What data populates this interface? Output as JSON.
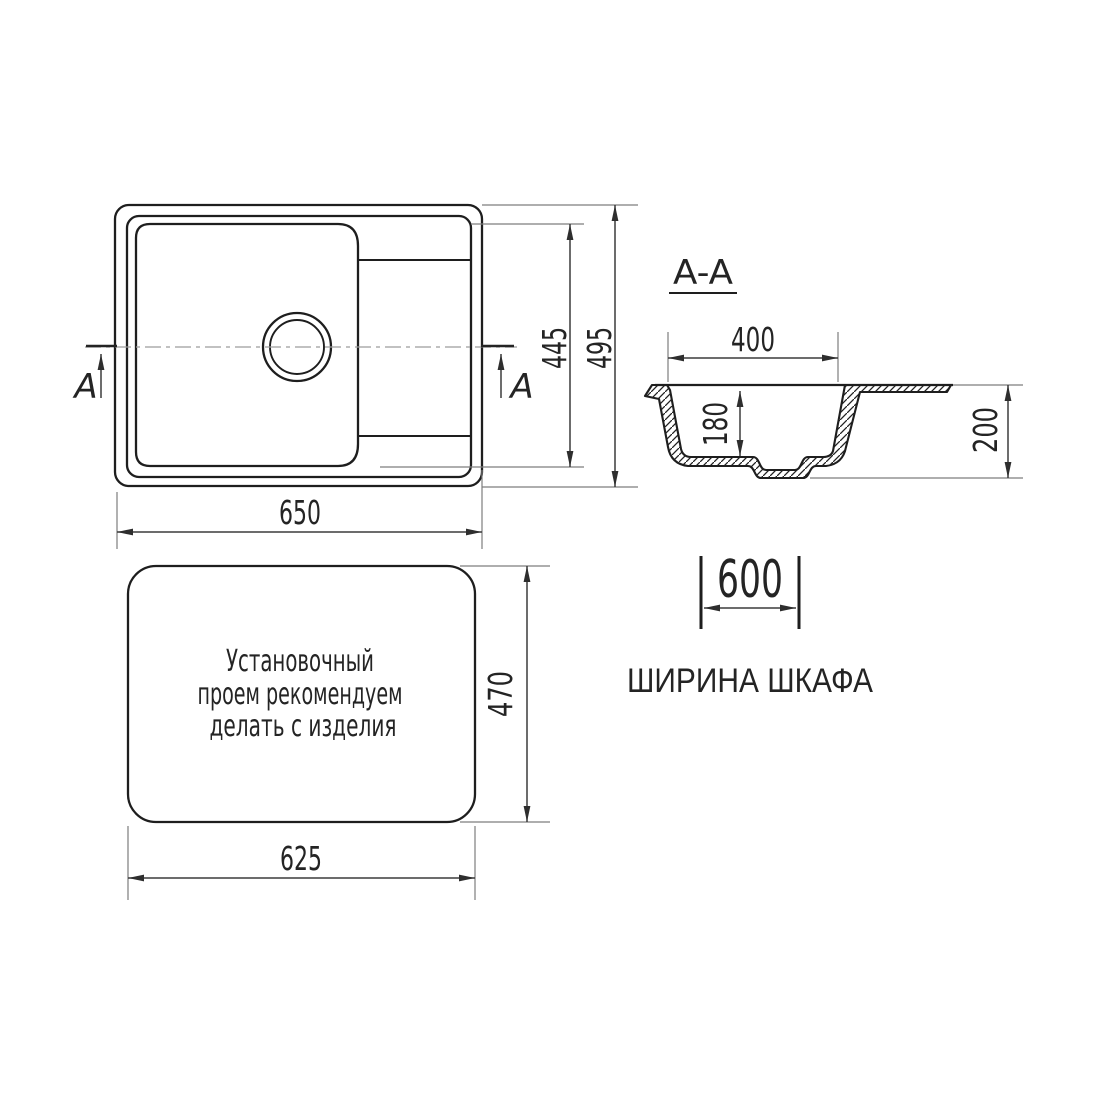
{
  "top_view": {
    "overall_width": "650",
    "bowl_length": "445",
    "overall_depth": "495",
    "section_letter": "A"
  },
  "section_view": {
    "label": "A-A",
    "bowl_width": "400",
    "bowl_depth": "180",
    "overall_height": "200"
  },
  "cutout_view": {
    "note": {
      "line1": "Установочный",
      "line2": "проем рекомендуем",
      "line3": "делать с изделия"
    },
    "cutout_width": "625",
    "cutout_depth": "470"
  },
  "cabinet": {
    "width": "600",
    "caption": "ШИРИНА ШКАФА"
  },
  "colors": {
    "outline": "#1e1e1e",
    "dimension": "#3c3c3c",
    "extension": "#7d7d7d",
    "centerline": "#9c9c9c",
    "background": "#ffffff"
  }
}
